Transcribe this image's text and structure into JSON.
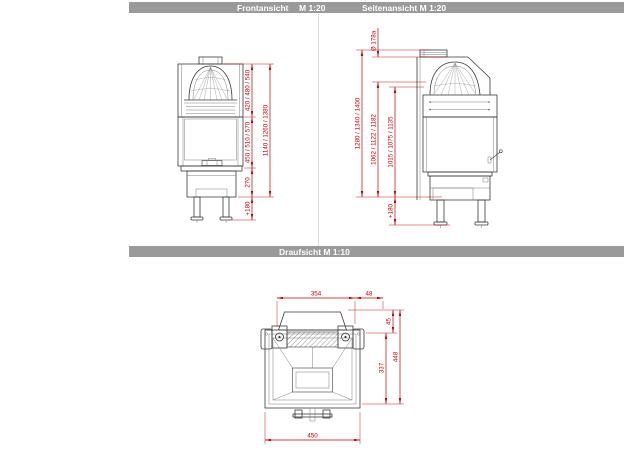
{
  "colors": {
    "dimension_red": "#c00000",
    "header_gray": "#9a9a9a",
    "header_text": "#ffffff",
    "line_dark": "#3a3a3a"
  },
  "headers": {
    "front_title": "Frontansicht",
    "front_scale": "M 1:20",
    "side_title": "Seitenansicht M 1:20",
    "top_title": "Draufsicht M 1:10"
  },
  "front_view": {
    "dims": {
      "top_section": "420 / 480 / 540",
      "door_section": "450 / 510 / 570",
      "base_section": "270",
      "legs": "+180",
      "overall_height": "1140 / 1260 / 1380"
    }
  },
  "side_view": {
    "dims": {
      "flue_diameter": "Ø 178a",
      "overall_height": "1280 / 1340 / 1400",
      "height_mid": "1062 / 1122 / 1182",
      "height_inner": "1015 / 1075 / 1135",
      "legs": "+180"
    }
  },
  "top_view": {
    "dims": {
      "back_width": "354",
      "side_offset": "48",
      "collar_depth": "45",
      "body_depth": "337",
      "total_depth": "448",
      "front_width": "450"
    }
  }
}
